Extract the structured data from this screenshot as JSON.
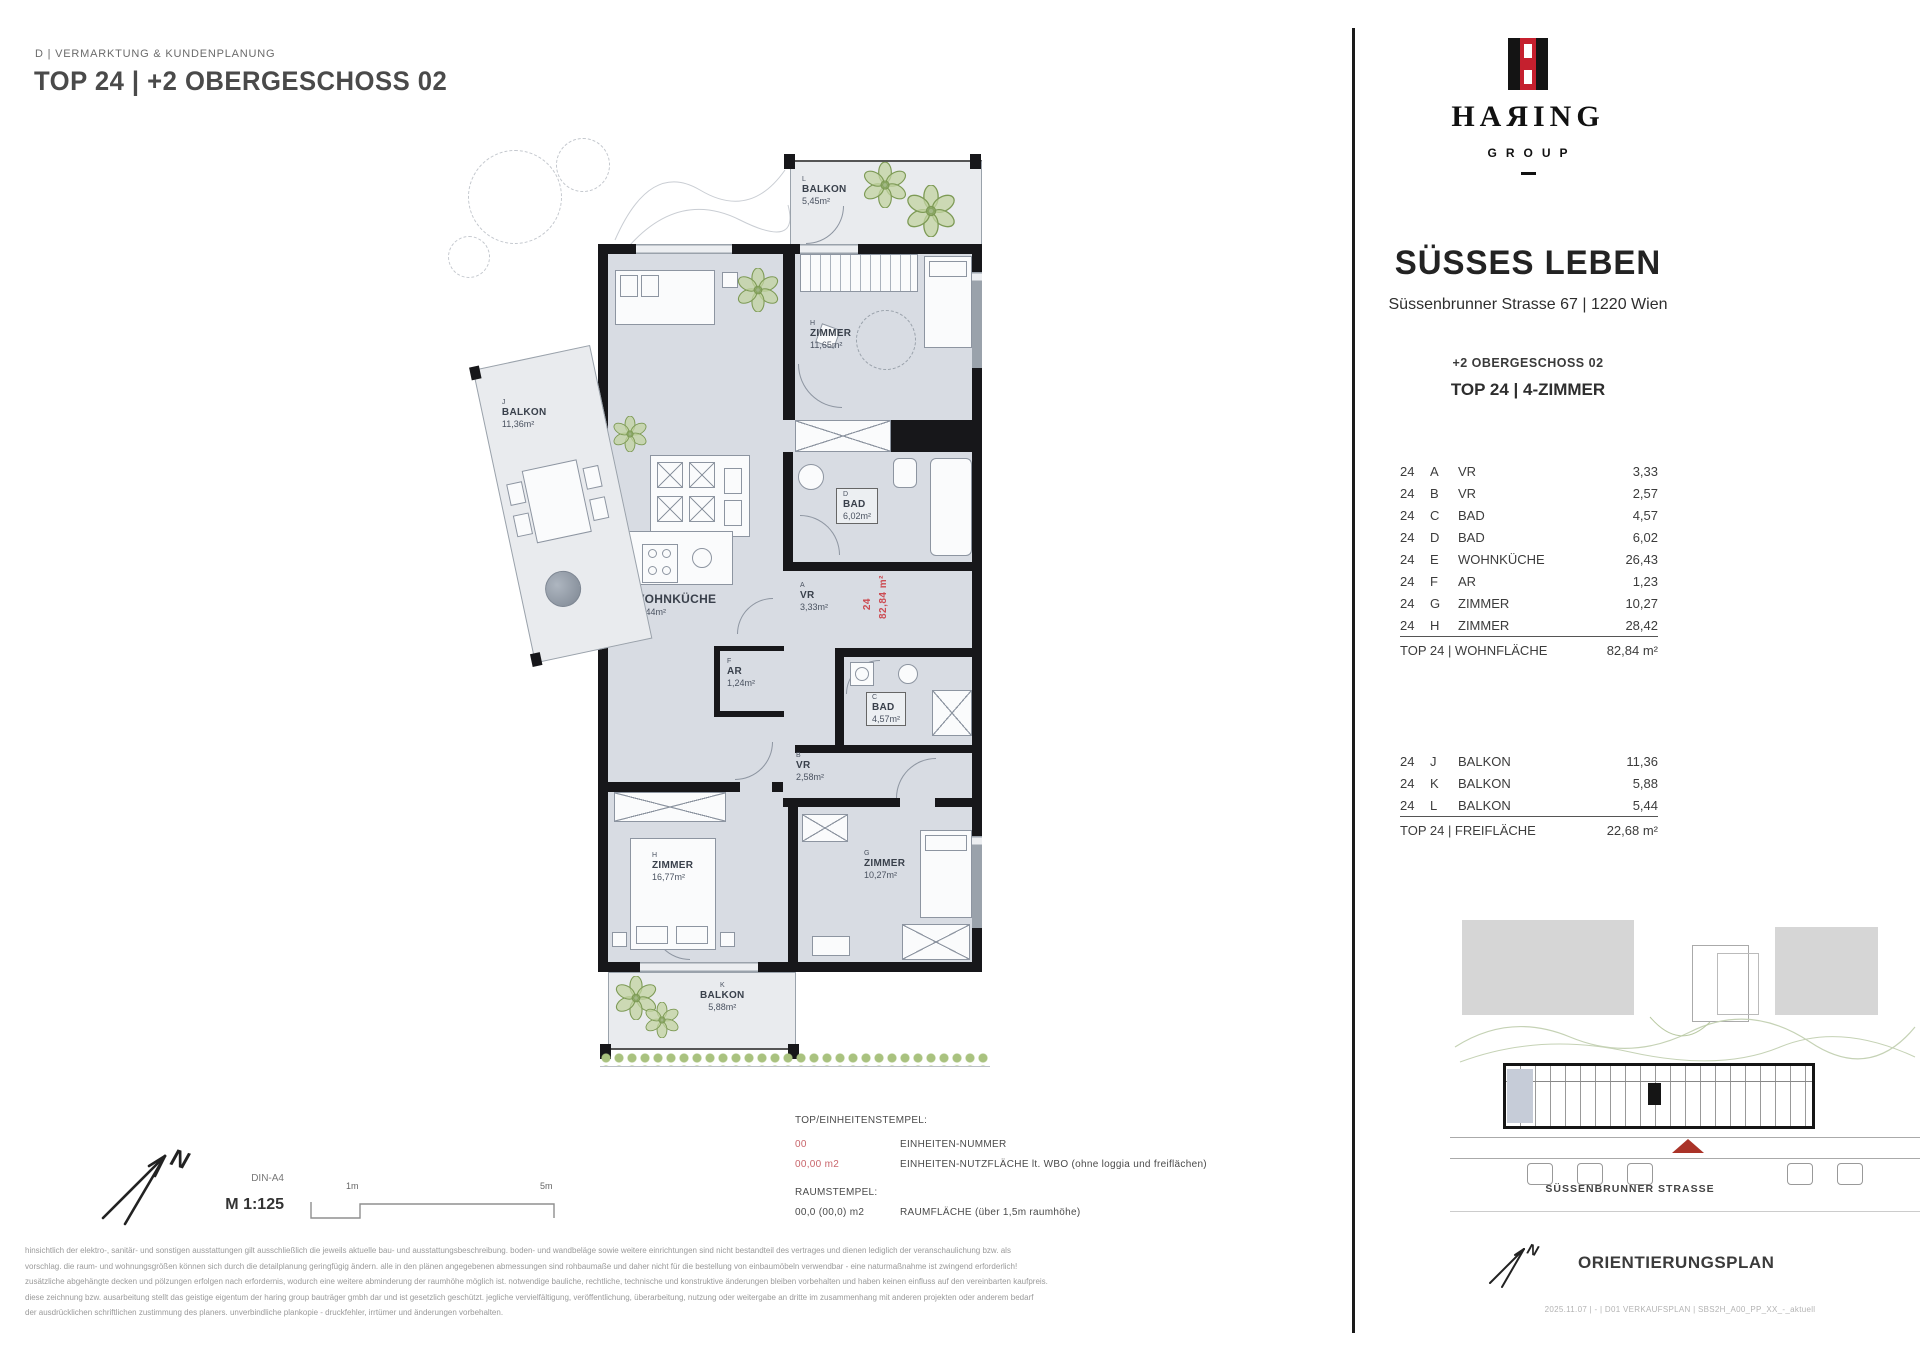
{
  "header": {
    "department": "D | VERMARKTUNG & KUNDENPLANUNG",
    "title": "TOP 24 | +2 OBERGESCHOSS 02"
  },
  "brand": {
    "name": "HAЯING",
    "group": "GROUP",
    "divider_dash": "",
    "project": "SÜSSES LEBEN",
    "address": "Süssenbrunner Strasse 67 | 1220 Wien",
    "floor": "+2 OBERGESCHOSS 02",
    "unit": "TOP 24 | 4-ZIMMER"
  },
  "rooms": [
    {
      "n": "24",
      "k": "A",
      "t": "VR",
      "a": "3,33"
    },
    {
      "n": "24",
      "k": "B",
      "t": "VR",
      "a": "2,57"
    },
    {
      "n": "24",
      "k": "C",
      "t": "BAD",
      "a": "4,57"
    },
    {
      "n": "24",
      "k": "D",
      "t": "BAD",
      "a": "6,02"
    },
    {
      "n": "24",
      "k": "E",
      "t": "WOHNKÜCHE",
      "a": "26,43"
    },
    {
      "n": "24",
      "k": "F",
      "t": "AR",
      "a": "1,23"
    },
    {
      "n": "24",
      "k": "G",
      "t": "ZIMMER",
      "a": "10,27"
    },
    {
      "n": "24",
      "k": "H",
      "t": "ZIMMER",
      "a": "28,42"
    }
  ],
  "rooms_total": {
    "label": "TOP 24 | WOHNFLÄCHE",
    "value": "82,84 m²"
  },
  "outdoor": [
    {
      "n": "24",
      "k": "J",
      "t": "BALKON",
      "a": "11,36"
    },
    {
      "n": "24",
      "k": "K",
      "t": "BALKON",
      "a": "5,88"
    },
    {
      "n": "24",
      "k": "L",
      "t": "BALKON",
      "a": "5,44"
    }
  ],
  "outdoor_total": {
    "label": "TOP 24 | FREIFLÄCHE",
    "value": "22,68 m²"
  },
  "plan": {
    "balcony_top": {
      "letter": "L",
      "name": "BALKON",
      "area": "5,45m²"
    },
    "balcony_left": {
      "letter": "J",
      "name": "BALKON",
      "area": "11,36m²"
    },
    "balcony_bottom": {
      "letter": "K",
      "name": "BALKON",
      "area": "5,88m²"
    },
    "zimmer_top": {
      "letter": "H",
      "name": "ZIMMER",
      "area": "11,65m²"
    },
    "zimmer_left": {
      "letter": "H",
      "name": "ZIMMER",
      "area": "16,77m²"
    },
    "zimmer_right": {
      "letter": "G",
      "name": "ZIMMER",
      "area": "10,27m²"
    },
    "bad_top": {
      "letter": "D",
      "name": "BAD",
      "area": "6,02m²"
    },
    "bad_bottom": {
      "letter": "C",
      "name": "BAD",
      "area": "4,57m²"
    },
    "vr_top": {
      "letter": "A",
      "name": "VR",
      "area": "3,33m²"
    },
    "vr_bottom": {
      "letter": "B",
      "name": "VR",
      "area": "2,58m²"
    },
    "ar": {
      "letter": "F",
      "name": "AR",
      "area": "1,24m²"
    },
    "stamp_number": "24",
    "stamp_area": "82,84 m²"
  },
  "legend": {
    "unit_stamp_title": "TOP/EINHEITENSTEMPEL:",
    "unit_number_sample": "00",
    "unit_number_desc": "EINHEITEN-NUMMER",
    "unit_area_sample": "00,00 m2",
    "unit_area_desc": "EINHEITEN-NUTZFLÄCHE lt. WBO (ohne loggia und freiflächen)",
    "room_stamp_title": "RAUMSTEMPEL:",
    "room_area_sample": "00,0 (00,0) m2",
    "room_area_desc": "RAUMFLÄCHE (über 1,5m raumhöhe)"
  },
  "scale": {
    "format": "DIN-A4",
    "ratio": "M 1:125",
    "tick_min": "1m",
    "tick_max": "5m"
  },
  "siteplan": {
    "street": "SÜSSENBRUNNER STRASSE",
    "title": "ORIENTIERUNGSPLAN",
    "footer": "2025.11.07 | - | D01 VERKAUFSPLAN | SBS2H_A00_PP_XX_-_aktuell"
  },
  "compass": {
    "north": "N"
  },
  "disclaimer": [
    "hinsichtlich der elektro-, sanitär- und sonstigen ausstattungen gilt ausschließlich die jeweils aktuelle bau- und ausstattungsbeschreibung. boden- und wandbeläge sowie weitere einrichtungen sind nicht bestandteil des vertrages und dienen lediglich der veranschaulichung bzw. als",
    "vorschlag. die raum- und wohnungsgrößen können sich durch die detailplanung geringfügig ändern. alle in den plänen angegebenen abmessungen sind rohbaumaße und daher nicht für die bestellung von einbaumöbeln verwendbar - eine naturmaßnahme ist zwingend erforderlich!",
    "zusätzliche abgehängte decken und pölzungen erfolgen nach erfordernis, wodurch eine weitere abminderung der raumhöhe möglich ist. notwendige bauliche, rechtliche, technische und konstruktive änderungen bleiben vorbehalten und haben keinen einfluss auf den vereinbarten kaufpreis.",
    "diese zeichnung bzw. ausarbeitung stellt das geistige eigentum der haring group bauträger gmbh dar und ist gesetzlich geschützt. jegliche vervielfältigung, veröffentlichung, überarbeitung, nutzung oder weitergabe an dritte im zusammenhang mit anderen projekten oder anderem bedarf",
    "der ausdrücklichen schriftlichen zustimmung des planers. unverbindliche plankopie - druckfehler, irrtümer und änderungen vorbehalten."
  ],
  "colors": {
    "brand_red": "#c5202e",
    "plan_red": "#cc4b52",
    "legend_red": "#c9666c",
    "marker_red": "#aa3328",
    "wall": "#17171a",
    "room_fill": "#d8dce3"
  }
}
